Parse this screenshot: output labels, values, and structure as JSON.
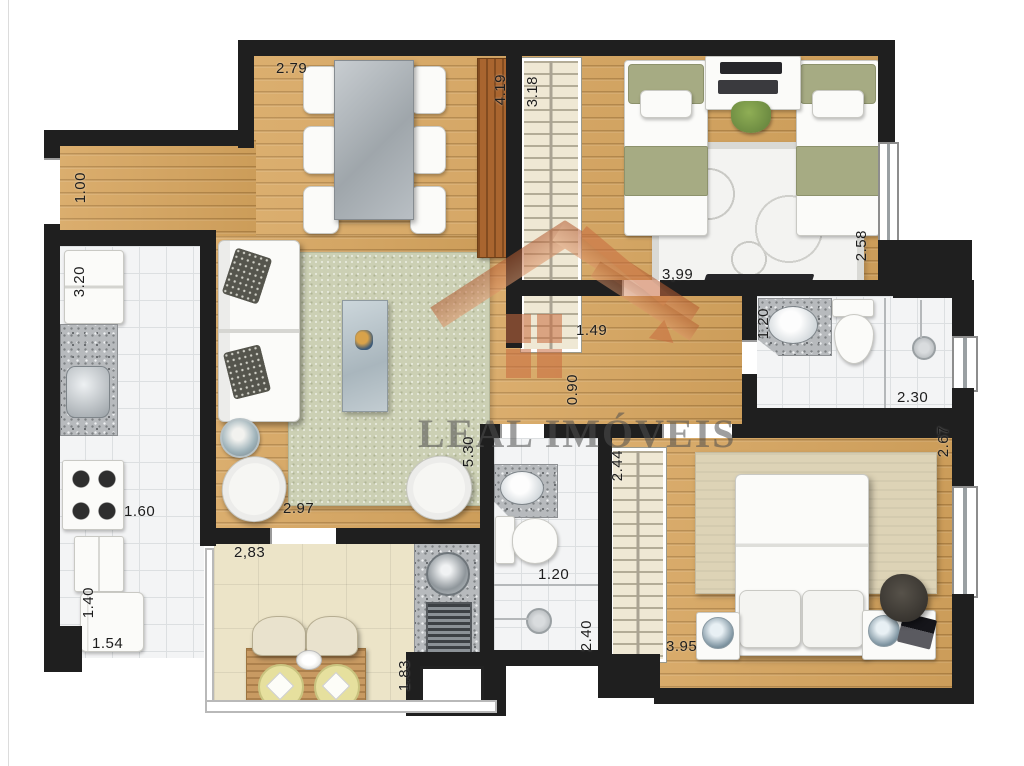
{
  "watermark": {
    "name": "LEAL IMÓVEIS"
  },
  "palette": {
    "wall": "#1f1f1f",
    "wood": "#d7a55e",
    "cabinet_wood": "#a9652f",
    "tile": "#f3f4f5",
    "balcony_floor": "#ece4c8",
    "granite": "#b7babd",
    "rug_sage": "#ccd0b4",
    "bed_green": "#a6ab83",
    "logo_orange": "#c96b3f"
  },
  "dimensions": [
    {
      "text": "1.00",
      "x": 72,
      "y": 172,
      "o": "v"
    },
    {
      "text": "2.79",
      "x": 276,
      "y": 60,
      "o": "h"
    },
    {
      "text": "4.19",
      "x": 492,
      "y": 74,
      "o": "v"
    },
    {
      "text": "3.18",
      "x": 524,
      "y": 76,
      "o": "v"
    },
    {
      "text": "3,99",
      "x": 662,
      "y": 266,
      "o": "h"
    },
    {
      "text": "2.58",
      "x": 853,
      "y": 230,
      "o": "v"
    },
    {
      "text": "1.20",
      "x": 755,
      "y": 308,
      "o": "v"
    },
    {
      "text": "2.30",
      "x": 897,
      "y": 389,
      "o": "h"
    },
    {
      "text": "1.49",
      "x": 576,
      "y": 322,
      "o": "h"
    },
    {
      "text": "0.90",
      "x": 564,
      "y": 374,
      "o": "v"
    },
    {
      "text": "3.20",
      "x": 71,
      "y": 266,
      "o": "v"
    },
    {
      "text": "1.60",
      "x": 124,
      "y": 503,
      "o": "h"
    },
    {
      "text": "1.40",
      "x": 80,
      "y": 587,
      "o": "v"
    },
    {
      "text": "1.54",
      "x": 92,
      "y": 635,
      "o": "h"
    },
    {
      "text": "5.30",
      "x": 460,
      "y": 436,
      "o": "v"
    },
    {
      "text": "2.97",
      "x": 283,
      "y": 500,
      "o": "h"
    },
    {
      "text": "2,83",
      "x": 234,
      "y": 544,
      "o": "h"
    },
    {
      "text": "1.83",
      "x": 396,
      "y": 660,
      "o": "v"
    },
    {
      "text": "1.20",
      "x": 538,
      "y": 566,
      "o": "h"
    },
    {
      "text": "2.40",
      "x": 578,
      "y": 620,
      "o": "v"
    },
    {
      "text": "2.44",
      "x": 609,
      "y": 450,
      "o": "v"
    },
    {
      "text": "3.95",
      "x": 666,
      "y": 638,
      "o": "h"
    },
    {
      "text": "2.67",
      "x": 935,
      "y": 426,
      "o": "v"
    }
  ]
}
